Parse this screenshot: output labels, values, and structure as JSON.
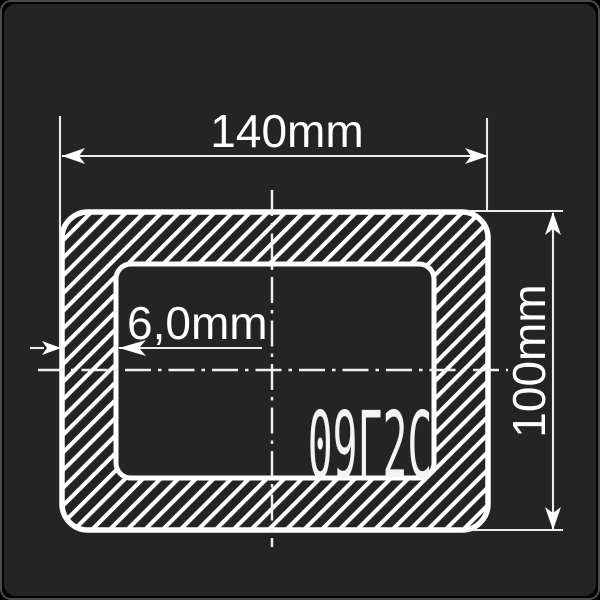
{
  "drawing": {
    "type": "rectangular-tube-cross-section",
    "dimensions": {
      "width_label": "140mm",
      "height_label": "100mm",
      "wall_thickness_label": "6,0mm"
    },
    "steel_grade_label": "09Г2С",
    "colors": {
      "page_background": "#000000",
      "panel_background": "#242424",
      "line": "#ffffff",
      "frame_border": "#4b4b4b"
    },
    "icons": {
      "hatch": "diagonal-hatch-pattern",
      "centerline": "dash-dot-centerline"
    }
  }
}
